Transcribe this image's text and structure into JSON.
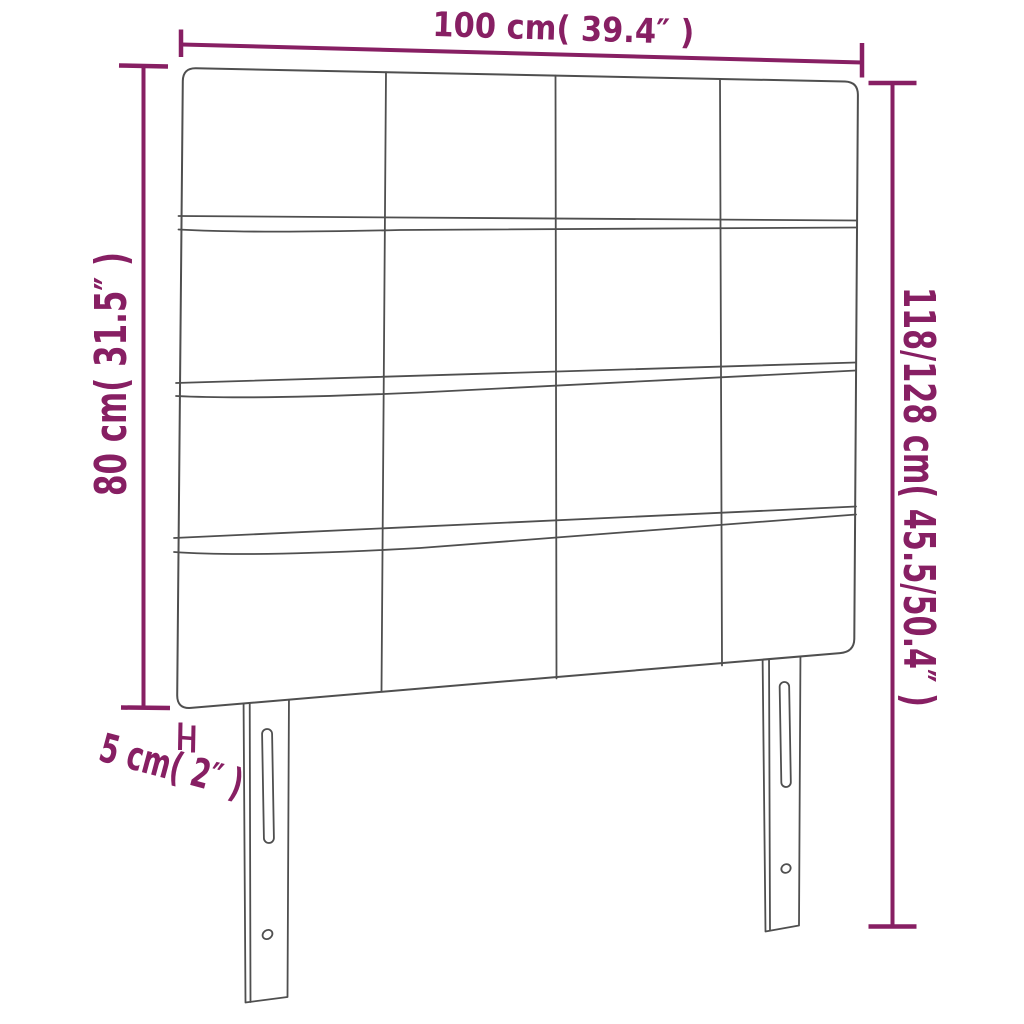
{
  "diagram": {
    "type": "product-dimension-diagram",
    "subject": "upholstered tufted headboard with two legs",
    "background": "#ffffff",
    "colors": {
      "dimension": "#871f63",
      "outline": "#4f4f4f",
      "fill": "#ffffff"
    },
    "dimensions": {
      "width_label": "100 cm( 39.4″ )",
      "board_height_label": "80 cm( 31.5″ )",
      "total_height_label": "118/128 cm( 45.5/50.4″ )",
      "thickness_label": "5 cm( 2″ )"
    },
    "structure": {
      "grid_rows": 4,
      "grid_columns": 4,
      "legs": 2,
      "slots_per_leg": 1,
      "holes_per_leg": 1
    }
  }
}
